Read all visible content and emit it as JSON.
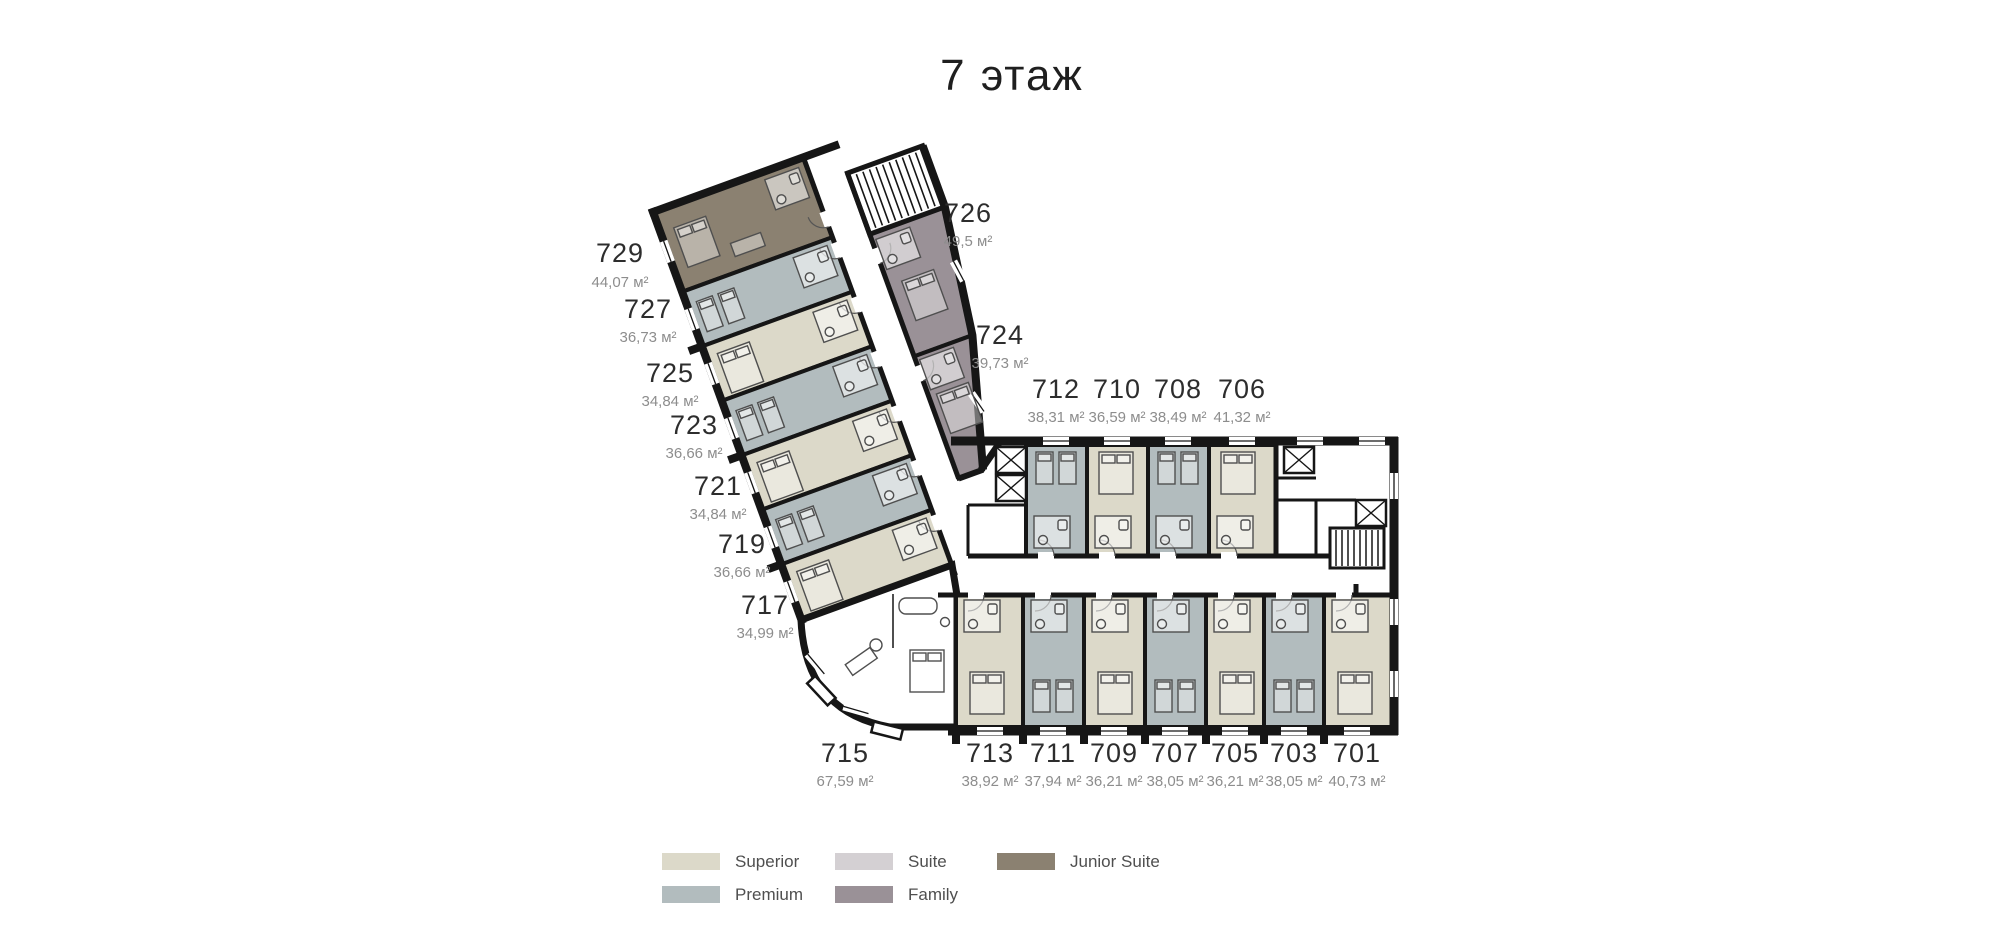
{
  "title": "7 этаж",
  "colors": {
    "superior": "#DCD9C9",
    "premium": "#B2BCBE",
    "suite": "#D4D0D3",
    "family": "#9A9197",
    "junior_suite": "#8B8171",
    "wall": "#161616"
  },
  "legend": {
    "items": [
      {
        "label": "Superior",
        "key": "superior"
      },
      {
        "label": "Premium",
        "key": "premium"
      },
      {
        "label": "Suite",
        "key": "suite"
      },
      {
        "label": "Family",
        "key": "family"
      },
      {
        "label": "Junior Suite",
        "key": "junior_suite"
      }
    ]
  },
  "rooms": [
    {
      "number": "729",
      "area": "44,07 м²",
      "type": "Junior Suite"
    },
    {
      "number": "727",
      "area": "36,73 м²",
      "type": "Premium"
    },
    {
      "number": "725",
      "area": "34,84 м²",
      "type": "Superior"
    },
    {
      "number": "723",
      "area": "36,66 м²",
      "type": "Premium"
    },
    {
      "number": "721",
      "area": "34,84 м²",
      "type": "Superior"
    },
    {
      "number": "719",
      "area": "36,66 м²",
      "type": "Premium"
    },
    {
      "number": "717",
      "area": "34,99 м²",
      "type": "Superior"
    },
    {
      "number": "715",
      "area": "67,59 м²",
      "type": "Suite"
    },
    {
      "number": "726",
      "area": "49,5 м²",
      "type": "Family"
    },
    {
      "number": "724",
      "area": "39,73 м²",
      "type": "Family"
    },
    {
      "number": "712",
      "area": "38,31 м²",
      "type": "Premium"
    },
    {
      "number": "710",
      "area": "36,59 м²",
      "type": "Superior"
    },
    {
      "number": "708",
      "area": "38,49 м²",
      "type": "Premium"
    },
    {
      "number": "706",
      "area": "41,32 м²",
      "type": "Superior"
    },
    {
      "number": "713",
      "area": "38,92 м²",
      "type": "Superior"
    },
    {
      "number": "711",
      "area": "37,94 м²",
      "type": "Premium"
    },
    {
      "number": "709",
      "area": "36,21 м²",
      "type": "Superior"
    },
    {
      "number": "707",
      "area": "38,05 м²",
      "type": "Premium"
    },
    {
      "number": "705",
      "area": "36,21 м²",
      "type": "Superior"
    },
    {
      "number": "703",
      "area": "38,05 м²",
      "type": "Premium"
    },
    {
      "number": "701",
      "area": "40,73 м²",
      "type": "Superior"
    }
  ]
}
